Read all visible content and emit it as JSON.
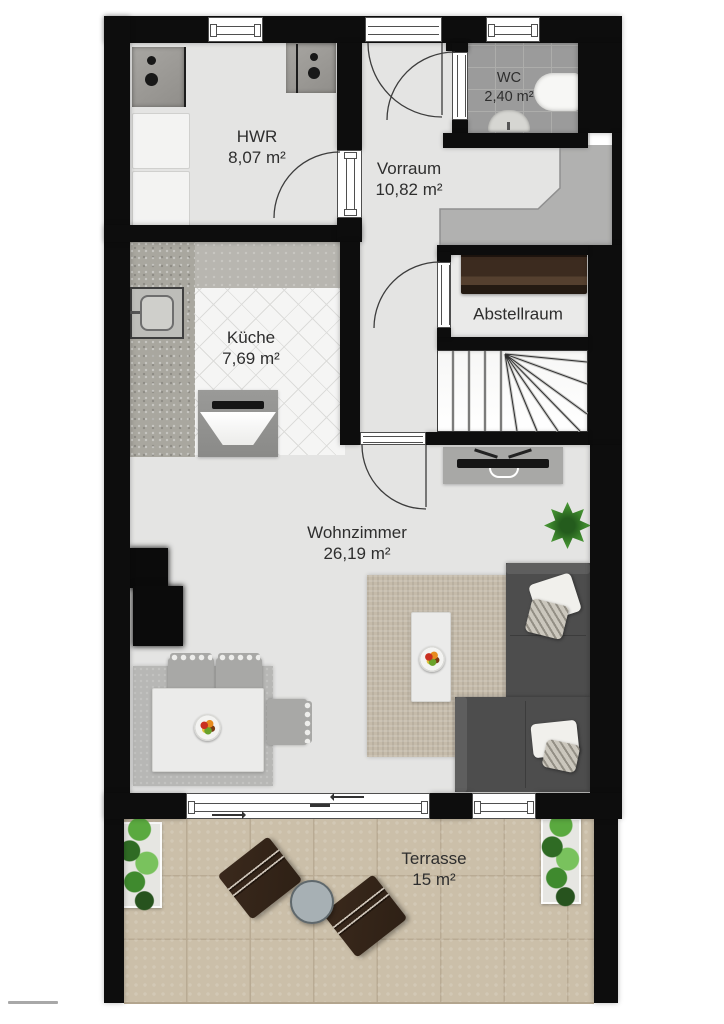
{
  "plan_type": "floor-plan",
  "rooms": {
    "hwr": {
      "name": "HWR",
      "area": "8,07 m²"
    },
    "wc": {
      "name": "WC",
      "area": "2,40 m²"
    },
    "vorraum": {
      "name": "Vorraum",
      "area": "10,82 m²"
    },
    "kueche": {
      "name": "Küche",
      "area": "7,69 m²"
    },
    "abstellraum": {
      "name": "Abstellraum"
    },
    "wohnzimmer": {
      "name": "Wohnzimmer",
      "area": "26,19 m²"
    },
    "terrasse": {
      "name": "Terrasse",
      "area": "15 m²"
    }
  },
  "furniture_items": [
    "washing machines",
    "storage cabinets",
    "toilet",
    "hand basin",
    "built-in wardrobe",
    "sideboard shelf",
    "winder staircase",
    "kitchen sink",
    "stove with extractor hood",
    "tv lowboard",
    "corner sofa with cushions",
    "coffee table with fruit bowl",
    "area rug",
    "dining table with chairs",
    "fireplace stove",
    "potted plant",
    "terrace planters",
    "terrace chairs",
    "round terrace table"
  ],
  "colors": {
    "wall": "#0d0d0d",
    "floor": "#e4e4e3",
    "kitchen_tile": "#f5f5f4",
    "counter": "#b8b6b0",
    "counter_speckle": "#a9a79f",
    "wc_tile": "#9b9b9b",
    "niche_gray": "#b1b1b0",
    "terrace": "#cbbfa9",
    "sofa": "#4d4d4d",
    "rug": "#c5bbaa",
    "dining_rug": "#b7b7b5",
    "furniture_gray": "#a8a8a6",
    "table_white": "#ebebea",
    "plant_green": "#3f8a2e",
    "terrace_chair": "#2e2015",
    "terrace_table": "#a7b0b4",
    "text": "#2e2e2e"
  }
}
